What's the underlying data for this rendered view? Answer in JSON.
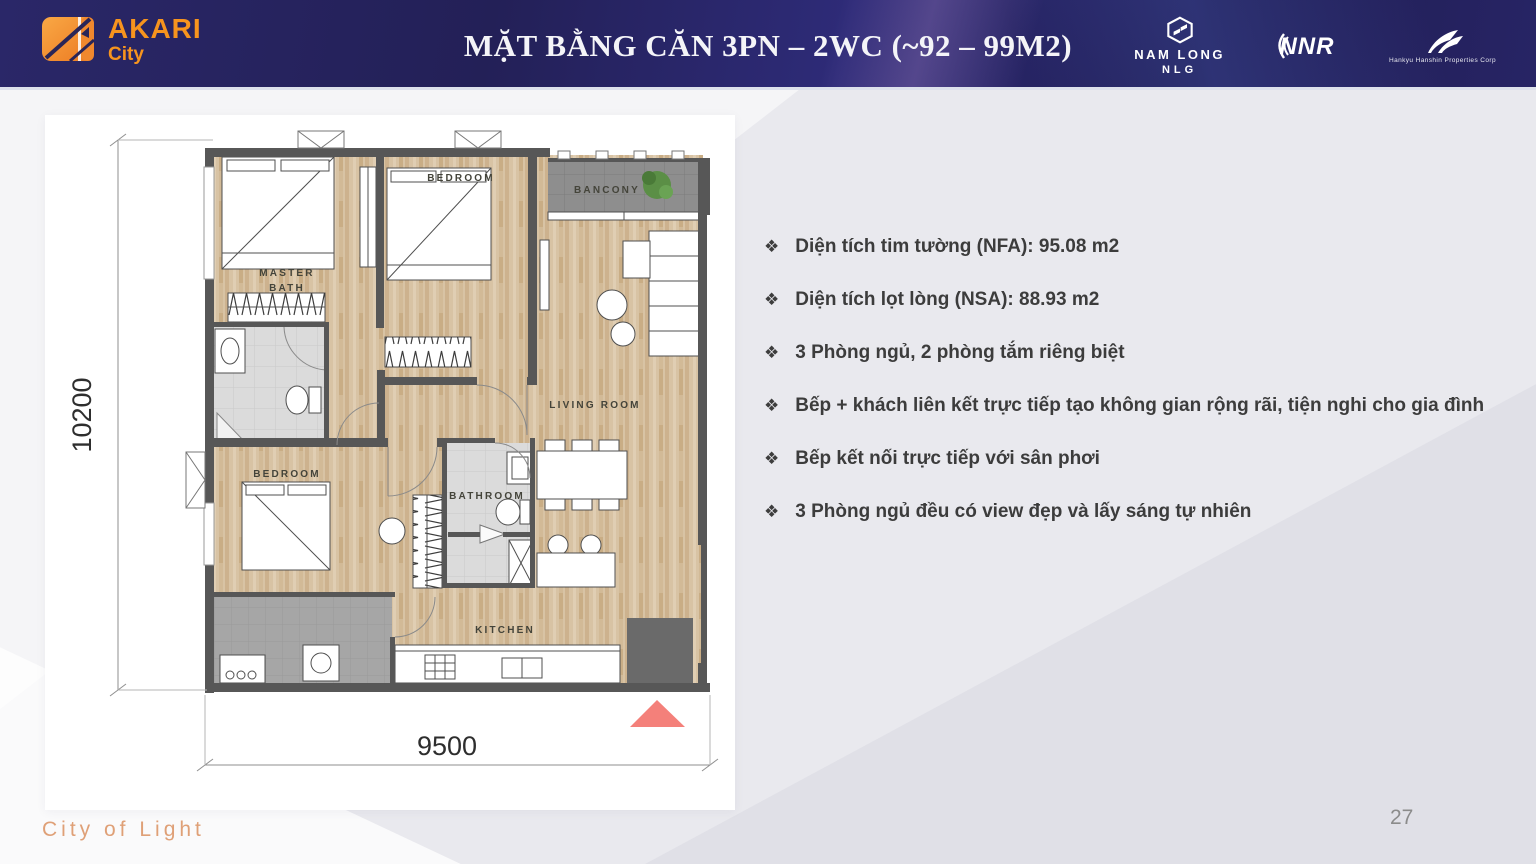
{
  "header": {
    "brand": {
      "name": "AKARI",
      "sub": "City"
    },
    "title": "MẶT BẰNG CĂN 3PN – 2WC (~92 – 99M2)",
    "partners": [
      {
        "name": "NAM LONG",
        "sub": "NLG"
      },
      {
        "name": "NNR"
      },
      {
        "name": "Hankyu Hanshin Properties Corp"
      }
    ]
  },
  "floorplan": {
    "labels": {
      "master_line1": "MASTER",
      "master_line2": "BATH",
      "bedroom_top": "BEDROOM",
      "balcony": "BANCONY",
      "living_room": "LIVING ROOM",
      "bedroom_bottom": "BEDROOM",
      "bathroom": "BATHROOM",
      "kitchen": "KITCHEN"
    },
    "dimensions": {
      "width_mm": "9500",
      "height_mm": "10200"
    }
  },
  "specs": {
    "bullet_glyph": "❖",
    "items": [
      "Diện tích tim tường (NFA): 95.08 m2",
      "Diện tích lọt lòng (NSA): 88.93 m2",
      "3 Phòng ngủ, 2 phòng tắm riêng biệt",
      "Bếp + khách liên kết trực tiếp tạo không gian rộng rãi, tiện nghi cho gia đình",
      "Bếp  kết nối trực tiếp với sân phơi",
      "3 Phòng ngủ đều có view đẹp và lấy sáng tự nhiên"
    ]
  },
  "footer": {
    "tagline": "City of Light",
    "page_number": "27"
  },
  "colors": {
    "header_navy": "#232058",
    "brand_orange": "#f7941e",
    "entry_arrow": "#f4807a",
    "tagline_orange": "#dfa077",
    "wall_gray": "#575757",
    "wood_floor": "#d8c3a4"
  }
}
